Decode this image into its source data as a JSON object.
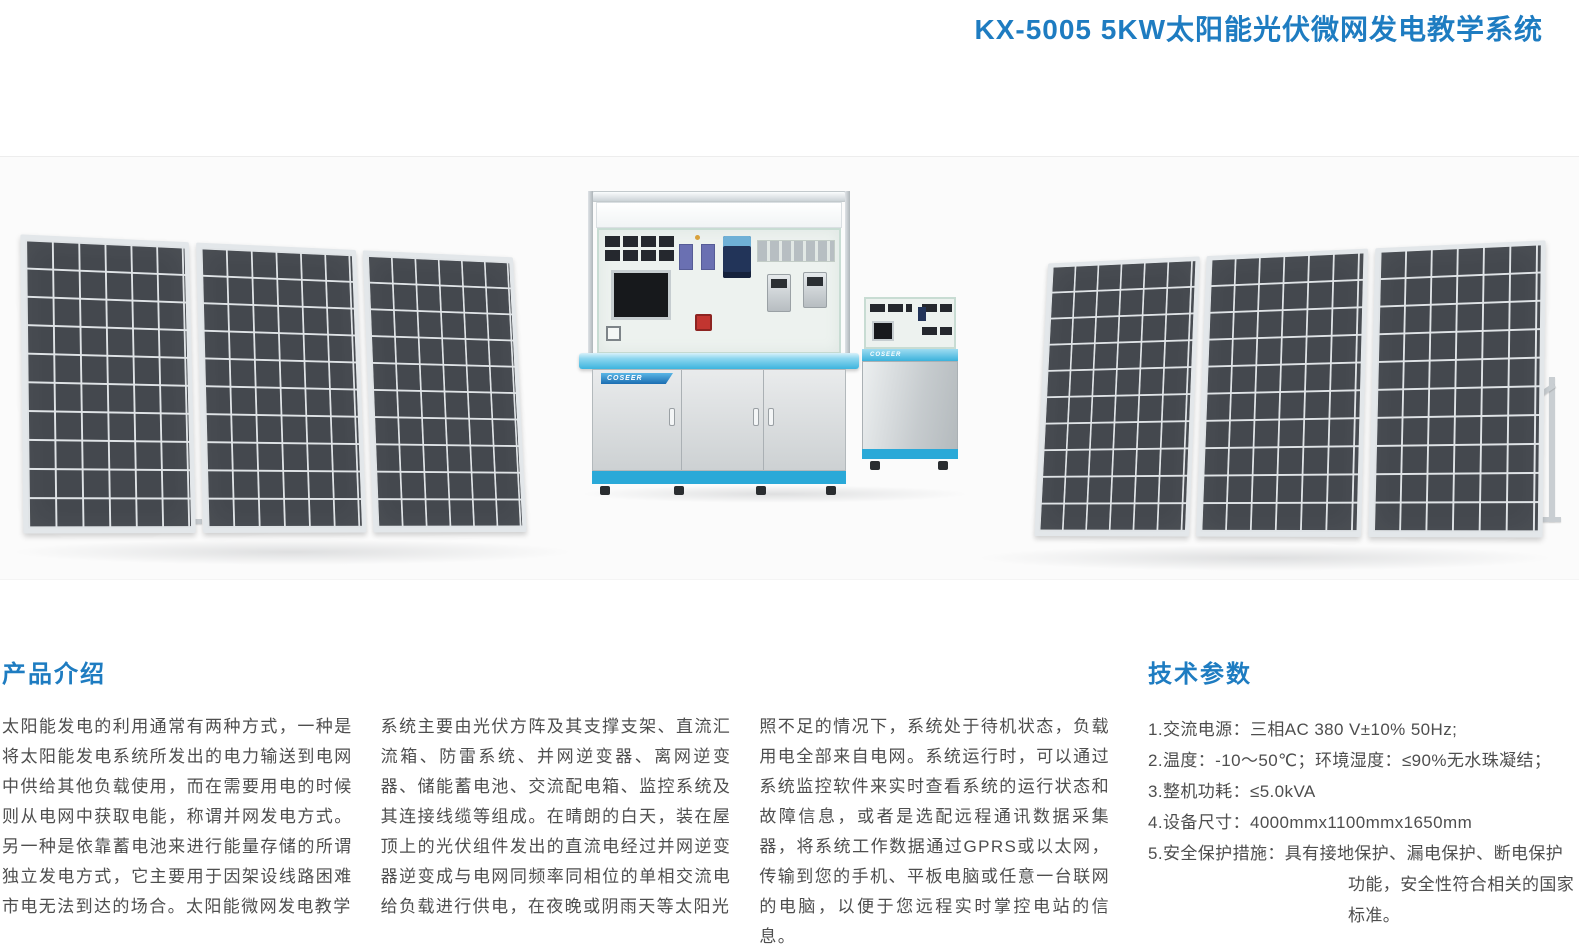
{
  "page": {
    "title": "KX-5005 5KW太阳能光伏微网发电教学系统"
  },
  "photo": {
    "brand": "COSEER"
  },
  "intro": {
    "heading": "产品介绍",
    "col1": "太阳能发电的利用通常有两种方式，一种是将太阳能发电系统所发出的电力输送到电网中供给其他负载使用，而在需要用电的时候则从电网中获取电能，称谓并网发电方式。另一种是依靠蓄电池来进行能量存储的所谓独立发电方式，它主要用于因架设线路困难市电无法到达的场合。太阳能微网发电教学",
    "col2": "系统主要由光伏方阵及其支撑支架、直流汇流箱、防雷系统、并网逆变器、离网逆变器、储能蓄电池、交流配电箱、监控系统及其连接线缆等组成。在晴朗的白天，装在屋顶上的光伏组件发出的直流电经过并网逆变器逆变成与电网同频率同相位的单相交流电给负载进行供电，在夜晚或阴雨天等太阳光",
    "col3": "照不足的情况下，系统处于待机状态，负载用电全部来自电网。系统运行时，可以通过系统监控软件来实时查看系统的运行状态和故障信息，或者是选配远程通讯数据采集器，将系统工作数据通过GPRS或以太网，传输到您的手机、平板电脑或任意一台联网的电脑，以便于您远程实时掌控电站的信息。"
  },
  "specs": {
    "heading": "技术参数",
    "items": [
      "1.交流电源：三相AC 380 V±10% 50Hz;",
      "2.温度：-10～50℃；环境湿度：≤90%无水珠凝结；",
      "3.整机功耗：≤5.0kVA",
      "4.设备尺寸：4000mmx1100mmx1650mm",
      "5.安全保护措施：具有接地保护、漏电保护、断电保护功能，安全性符合相关的国家标准。"
    ]
  },
  "colors": {
    "accent_blue": "#1e7cc1",
    "desk_cyan": "#3db4de",
    "base_cyan": "#2aa9d8",
    "cell_dark": "#44484e"
  }
}
